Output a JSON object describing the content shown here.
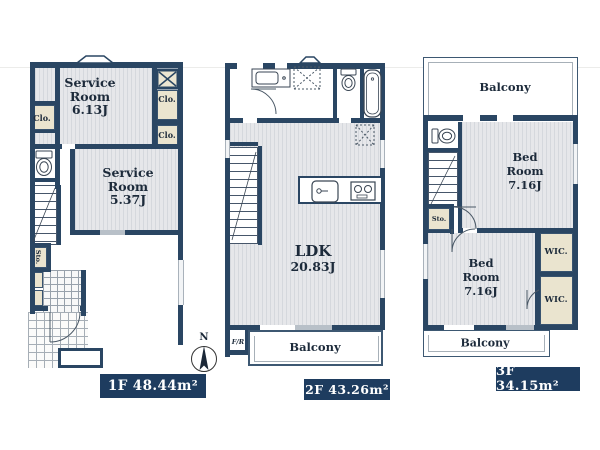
{
  "floor1": {
    "badge": "1F 48.44m²",
    "room1": {
      "l1": "Service",
      "l2": "Room",
      "l3": "6.13J"
    },
    "room2": {
      "l1": "Service",
      "l2": "Room",
      "l3": "5.37J"
    },
    "clo_right_top": "Clo.",
    "clo_right_mid": "Clo.",
    "clo_left": "Clo.",
    "sto": "Sto."
  },
  "floor2": {
    "badge": "2F 43.26m²",
    "ldk": {
      "l1": "LDK",
      "l2": "20.83J"
    },
    "balcony": "Balcony",
    "fr": "F/R"
  },
  "floor3": {
    "badge": "3F 34.15m²",
    "balcony_top": "Balcony",
    "balcony_bottom": "Balcony",
    "bed1": {
      "l1": "Bed",
      "l2": "Room",
      "l3": "7.16J"
    },
    "bed2": {
      "l1": "Bed",
      "l2": "Room",
      "l3": "7.16J"
    },
    "wic1": "WIC.",
    "wic2": "WIC.",
    "sto": "Sto."
  },
  "compass": {
    "north": "N"
  },
  "colors": {
    "wall": "#2a4663",
    "floor": "#e6e7ea",
    "closet": "#eae4cf",
    "badge_bg": "#1e3c5f",
    "badge_text": "#ffffff"
  }
}
